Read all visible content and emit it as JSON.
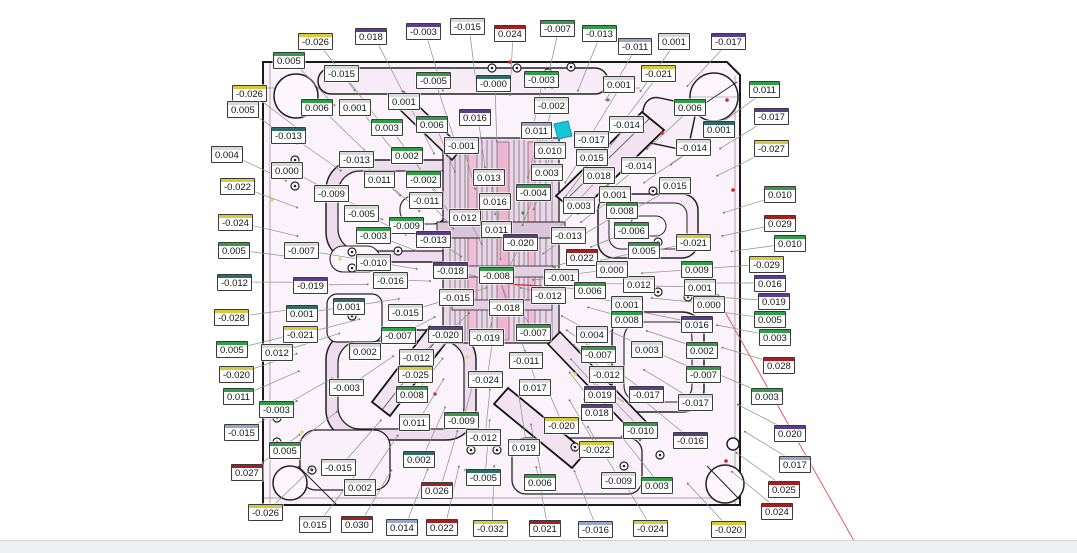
{
  "canvas": {
    "width": 1077,
    "height": 553,
    "background": "#ffffff"
  },
  "statusband": {
    "background": "#edeff1"
  },
  "plate": {
    "fill": "#fbf2fb",
    "pocket_fill": "#eedcee",
    "stroke": "#1a1a1a",
    "highlight_marker_color": "#16c6d8",
    "red_leader_color": "#e05c5c"
  },
  "stripe_colors": {
    "g": "#2f9e44",
    "r": "#a41f1f",
    "y": "#d9c93e",
    "p": "#5b3d8f",
    "b": "#9aa6c8",
    "t": "#2e6b6b",
    "w": "#d9d9d9"
  },
  "labels": [
    {
      "t": "-0.026",
      "c": "y",
      "x": 298,
      "y": 33
    },
    {
      "t": "0.018",
      "c": "p",
      "x": 355,
      "y": 28
    },
    {
      "t": "-0.003",
      "c": "p",
      "x": 406,
      "y": 23
    },
    {
      "t": "-0.015",
      "c": "w",
      "x": 450,
      "y": 18
    },
    {
      "t": "0.024",
      "c": "r",
      "x": 494,
      "y": 25
    },
    {
      "t": "-0.007",
      "c": "g",
      "x": 540,
      "y": 20
    },
    {
      "t": "-0.013",
      "c": "g",
      "x": 582,
      "y": 25
    },
    {
      "t": "-0.011",
      "c": "b",
      "x": 618,
      "y": 38
    },
    {
      "t": "0.001",
      "c": "w",
      "x": 658,
      "y": 33
    },
    {
      "t": "-0.017",
      "c": "p",
      "x": 711,
      "y": 33
    },
    {
      "t": "0.005",
      "c": "g",
      "x": 273,
      "y": 52
    },
    {
      "t": "-0.015",
      "c": "w",
      "x": 324,
      "y": 65
    },
    {
      "t": "-0.005",
      "c": "g",
      "x": 416,
      "y": 72
    },
    {
      "t": "-0.000",
      "c": "t",
      "x": 476,
      "y": 75
    },
    {
      "t": "-0.003",
      "c": "g",
      "x": 524,
      "y": 71
    },
    {
      "t": "0.001",
      "c": "w",
      "x": 603,
      "y": 76
    },
    {
      "t": "-0.021",
      "c": "y",
      "x": 641,
      "y": 65
    },
    {
      "t": "0.011",
      "c": "g",
      "x": 749,
      "y": 81
    },
    {
      "t": "0.006",
      "c": "g",
      "x": 301,
      "y": 99
    },
    {
      "t": "0.001",
      "c": "w",
      "x": 339,
      "y": 99
    },
    {
      "t": "0.001",
      "c": "w",
      "x": 388,
      "y": 93
    },
    {
      "t": "-0.002",
      "c": "w",
      "x": 534,
      "y": 97
    },
    {
      "t": "0.006",
      "c": "g",
      "x": 674,
      "y": 99
    },
    {
      "t": "-0.017",
      "c": "p",
      "x": 754,
      "y": 108
    },
    {
      "t": "0.001",
      "c": "t",
      "x": 703,
      "y": 121
    },
    {
      "t": "-0.014",
      "c": "w",
      "x": 609,
      "y": 116
    },
    {
      "t": "-0.027",
      "c": "y",
      "x": 754,
      "y": 140
    },
    {
      "t": "-0.014",
      "c": "w",
      "x": 676,
      "y": 139
    },
    {
      "t": "-0.014",
      "c": "w",
      "x": 621,
      "y": 157
    },
    {
      "t": "0.015",
      "c": "w",
      "x": 659,
      "y": 177
    },
    {
      "t": "-0.026",
      "c": "y",
      "x": 232,
      "y": 85
    },
    {
      "t": "0.005",
      "c": "w",
      "x": 227,
      "y": 101
    },
    {
      "t": "0.004",
      "c": "w",
      "x": 211,
      "y": 146
    },
    {
      "t": "-0.022",
      "c": "y",
      "x": 220,
      "y": 178
    },
    {
      "t": "-0.024",
      "c": "y",
      "x": 218,
      "y": 214
    },
    {
      "t": "0.005",
      "c": "g",
      "x": 218,
      "y": 242
    },
    {
      "t": "-0.012",
      "c": "t",
      "x": 217,
      "y": 274
    },
    {
      "t": "-0.028",
      "c": "y",
      "x": 214,
      "y": 309
    },
    {
      "t": "0.005",
      "c": "g",
      "x": 216,
      "y": 341
    },
    {
      "t": "0.012",
      "c": "w",
      "x": 261,
      "y": 344
    },
    {
      "t": "-0.020",
      "c": "y",
      "x": 219,
      "y": 366
    },
    {
      "t": "0.011",
      "c": "g",
      "x": 223,
      "y": 388
    },
    {
      "t": "-0.003",
      "c": "g",
      "x": 259,
      "y": 401
    },
    {
      "t": "-0.015",
      "c": "b",
      "x": 224,
      "y": 424
    },
    {
      "t": "0.027",
      "c": "r",
      "x": 231,
      "y": 464
    },
    {
      "t": "-0.026",
      "c": "y",
      "x": 248,
      "y": 504
    },
    {
      "t": "0.015",
      "c": "w",
      "x": 299,
      "y": 516
    },
    {
      "t": "0.030",
      "c": "r",
      "x": 341,
      "y": 516
    },
    {
      "t": "0.014",
      "c": "b",
      "x": 386,
      "y": 519
    },
    {
      "t": "0.022",
      "c": "r",
      "x": 426,
      "y": 519
    },
    {
      "t": "-0.032",
      "c": "y",
      "x": 473,
      "y": 520
    },
    {
      "t": "0.021",
      "c": "r",
      "x": 529,
      "y": 520
    },
    {
      "t": "-0.016",
      "c": "b",
      "x": 578,
      "y": 521
    },
    {
      "t": "-0.024",
      "c": "y",
      "x": 633,
      "y": 520
    },
    {
      "t": "-0.020",
      "c": "y",
      "x": 711,
      "y": 521
    },
    {
      "t": "0.024",
      "c": "r",
      "x": 761,
      "y": 503
    },
    {
      "t": "0.025",
      "c": "r",
      "x": 768,
      "y": 481
    },
    {
      "t": "0.017",
      "c": "b",
      "x": 779,
      "y": 456
    },
    {
      "t": "0.020",
      "c": "p",
      "x": 774,
      "y": 425
    },
    {
      "t": "0.010",
      "c": "g",
      "x": 764,
      "y": 186
    },
    {
      "t": "0.029",
      "c": "r",
      "x": 764,
      "y": 215
    },
    {
      "t": "0.010",
      "c": "g",
      "x": 774,
      "y": 235
    },
    {
      "t": "-0.029",
      "c": "y",
      "x": 749,
      "y": 256
    },
    {
      "t": "0.016",
      "c": "p",
      "x": 754,
      "y": 275
    },
    {
      "t": "0.019",
      "c": "p",
      "x": 758,
      "y": 293
    },
    {
      "t": "0.005",
      "c": "g",
      "x": 754,
      "y": 311
    },
    {
      "t": "0.003",
      "c": "g",
      "x": 759,
      "y": 329
    },
    {
      "t": "0.028",
      "c": "r",
      "x": 763,
      "y": 357
    },
    {
      "t": "0.003",
      "c": "g",
      "x": 751,
      "y": 388
    },
    {
      "t": "-0.013",
      "c": "t",
      "x": 271,
      "y": 127
    },
    {
      "t": "0.003",
      "c": "g",
      "x": 371,
      "y": 119
    },
    {
      "t": "0.006",
      "c": "g",
      "x": 416,
      "y": 116
    },
    {
      "t": "0.016",
      "c": "p",
      "x": 459,
      "y": 109
    },
    {
      "t": "0.002",
      "c": "g",
      "x": 391,
      "y": 147
    },
    {
      "t": "-0.013",
      "c": "w",
      "x": 339,
      "y": 151
    },
    {
      "t": "0.011",
      "c": "w",
      "x": 364,
      "y": 171
    },
    {
      "t": "-0.002",
      "c": "g",
      "x": 406,
      "y": 171
    },
    {
      "t": "0.000",
      "c": "w",
      "x": 271,
      "y": 162
    },
    {
      "t": "-0.009",
      "c": "w",
      "x": 314,
      "y": 185
    },
    {
      "t": "-0.011",
      "c": "w",
      "x": 409,
      "y": 192
    },
    {
      "t": "-0.005",
      "c": "w",
      "x": 344,
      "y": 205
    },
    {
      "t": "-0.009",
      "c": "g",
      "x": 389,
      "y": 217
    },
    {
      "t": "-0.003",
      "c": "g",
      "x": 356,
      "y": 227
    },
    {
      "t": "-0.013",
      "c": "p",
      "x": 416,
      "y": 231
    },
    {
      "t": "0.012",
      "c": "w",
      "x": 449,
      "y": 209
    },
    {
      "t": "-0.001",
      "c": "w",
      "x": 444,
      "y": 137
    },
    {
      "t": "0.011",
      "c": "b",
      "x": 521,
      "y": 122
    },
    {
      "t": "0.010",
      "c": "w",
      "x": 534,
      "y": 142
    },
    {
      "t": "-0.017",
      "c": "w",
      "x": 574,
      "y": 131
    },
    {
      "t": "0.015",
      "c": "w",
      "x": 576,
      "y": 149
    },
    {
      "t": "0.013",
      "c": "w",
      "x": 473,
      "y": 169
    },
    {
      "t": "0.003",
      "c": "w",
      "x": 531,
      "y": 164
    },
    {
      "t": "0.018",
      "c": "w",
      "x": 583,
      "y": 167
    },
    {
      "t": "-0.004",
      "c": "g",
      "x": 516,
      "y": 184
    },
    {
      "t": "0.016",
      "c": "w",
      "x": 479,
      "y": 193
    },
    {
      "t": "0.001",
      "c": "w",
      "x": 599,
      "y": 186
    },
    {
      "t": "0.003",
      "c": "w",
      "x": 563,
      "y": 197
    },
    {
      "t": "0.008",
      "c": "g",
      "x": 606,
      "y": 202
    },
    {
      "t": "-0.006",
      "c": "g",
      "x": 614,
      "y": 222
    },
    {
      "t": "0.005",
      "c": "g",
      "x": 628,
      "y": 242
    },
    {
      "t": "-0.021",
      "c": "y",
      "x": 676,
      "y": 234
    },
    {
      "t": "0.009",
      "c": "g",
      "x": 681,
      "y": 261
    },
    {
      "t": "0.012",
      "c": "w",
      "x": 623,
      "y": 276
    },
    {
      "t": "0.001",
      "c": "w",
      "x": 684,
      "y": 279
    },
    {
      "t": "0.001",
      "c": "w",
      "x": 611,
      "y": 296
    },
    {
      "t": "0.000",
      "c": "w",
      "x": 693,
      "y": 296
    },
    {
      "t": "0.008",
      "c": "g",
      "x": 611,
      "y": 311
    },
    {
      "t": "0.016",
      "c": "p",
      "x": 681,
      "y": 316
    },
    {
      "t": "-0.007",
      "c": "w",
      "x": 284,
      "y": 242
    },
    {
      "t": "-0.019",
      "c": "p",
      "x": 293,
      "y": 277
    },
    {
      "t": "0.001",
      "c": "t",
      "x": 286,
      "y": 305
    },
    {
      "t": "-0.021",
      "c": "y",
      "x": 283,
      "y": 326
    },
    {
      "t": "-0.010",
      "c": "w",
      "x": 356,
      "y": 254
    },
    {
      "t": "-0.016",
      "c": "w",
      "x": 373,
      "y": 272
    },
    {
      "t": "0.001",
      "c": "t",
      "x": 333,
      "y": 298
    },
    {
      "t": "-0.015",
      "c": "w",
      "x": 388,
      "y": 304
    },
    {
      "t": "-0.007",
      "c": "g",
      "x": 381,
      "y": 327
    },
    {
      "t": "0.002",
      "c": "w",
      "x": 349,
      "y": 343
    },
    {
      "t": "-0.003",
      "c": "w",
      "x": 329,
      "y": 379
    },
    {
      "t": "0.011",
      "c": "w",
      "x": 481,
      "y": 221
    },
    {
      "t": "-0.020",
      "c": "p",
      "x": 503,
      "y": 234
    },
    {
      "t": "-0.013",
      "c": "w",
      "x": 551,
      "y": 227
    },
    {
      "t": "0.022",
      "c": "r",
      "x": 566,
      "y": 249
    },
    {
      "t": "0.000",
      "c": "w",
      "x": 596,
      "y": 261
    },
    {
      "t": "-0.018",
      "c": "p",
      "x": 433,
      "y": 262
    },
    {
      "t": "-0.008",
      "c": "g",
      "x": 479,
      "y": 267
    },
    {
      "t": "-0.001",
      "c": "w",
      "x": 544,
      "y": 269
    },
    {
      "t": "0.006",
      "c": "g",
      "x": 574,
      "y": 282
    },
    {
      "t": "-0.015",
      "c": "w",
      "x": 439,
      "y": 289
    },
    {
      "t": "-0.012",
      "c": "w",
      "x": 531,
      "y": 287
    },
    {
      "t": "-0.018",
      "c": "w",
      "x": 489,
      "y": 299
    },
    {
      "t": "-0.007",
      "c": "g",
      "x": 516,
      "y": 324
    },
    {
      "t": "-0.020",
      "c": "p",
      "x": 428,
      "y": 326
    },
    {
      "t": "-0.019",
      "c": "w",
      "x": 469,
      "y": 329
    },
    {
      "t": "0.004",
      "c": "w",
      "x": 576,
      "y": 326
    },
    {
      "t": "0.003",
      "c": "w",
      "x": 631,
      "y": 341
    },
    {
      "t": "0.002",
      "c": "g",
      "x": 686,
      "y": 342
    },
    {
      "t": "-0.007",
      "c": "g",
      "x": 581,
      "y": 346
    },
    {
      "t": "-0.012",
      "c": "w",
      "x": 589,
      "y": 366
    },
    {
      "t": "-0.007",
      "c": "g",
      "x": 686,
      "y": 366
    },
    {
      "t": "0.019",
      "c": "p",
      "x": 584,
      "y": 386
    },
    {
      "t": "-0.017",
      "c": "p",
      "x": 629,
      "y": 386
    },
    {
      "t": "-0.017",
      "c": "w",
      "x": 678,
      "y": 394
    },
    {
      "t": "0.018",
      "c": "p",
      "x": 581,
      "y": 404
    },
    {
      "t": "-0.010",
      "c": "g",
      "x": 623,
      "y": 422
    },
    {
      "t": "-0.016",
      "c": "p",
      "x": 673,
      "y": 432
    },
    {
      "t": "-0.020",
      "c": "y",
      "x": 544,
      "y": 417
    },
    {
      "t": "-0.012",
      "c": "w",
      "x": 399,
      "y": 349
    },
    {
      "t": "-0.011",
      "c": "w",
      "x": 509,
      "y": 352
    },
    {
      "t": "-0.025",
      "c": "y",
      "x": 398,
      "y": 366
    },
    {
      "t": "-0.024",
      "c": "w",
      "x": 468,
      "y": 371
    },
    {
      "t": "0.017",
      "c": "w",
      "x": 519,
      "y": 379
    },
    {
      "t": "0.008",
      "c": "g",
      "x": 396,
      "y": 386
    },
    {
      "t": "0.011",
      "c": "w",
      "x": 399,
      "y": 414
    },
    {
      "t": "-0.009",
      "c": "g",
      "x": 444,
      "y": 412
    },
    {
      "t": "-0.012",
      "c": "w",
      "x": 466,
      "y": 429
    },
    {
      "t": "0.019",
      "c": "w",
      "x": 508,
      "y": 439
    },
    {
      "t": "0.002",
      "c": "t",
      "x": 403,
      "y": 451
    },
    {
      "t": "-0.022",
      "c": "y",
      "x": 579,
      "y": 441
    },
    {
      "t": "-0.005",
      "c": "t",
      "x": 466,
      "y": 469
    },
    {
      "t": "0.026",
      "c": "r",
      "x": 421,
      "y": 482
    },
    {
      "t": "0.006",
      "c": "g",
      "x": 524,
      "y": 474
    },
    {
      "t": "-0.009",
      "c": "w",
      "x": 601,
      "y": 472
    },
    {
      "t": "0.003",
      "c": "g",
      "x": 641,
      "y": 477
    },
    {
      "t": "0.002",
      "c": "w",
      "x": 344,
      "y": 479
    },
    {
      "t": "0.005",
      "c": "g",
      "x": 269,
      "y": 442
    },
    {
      "t": "-0.015",
      "c": "w",
      "x": 321,
      "y": 459
    }
  ]
}
